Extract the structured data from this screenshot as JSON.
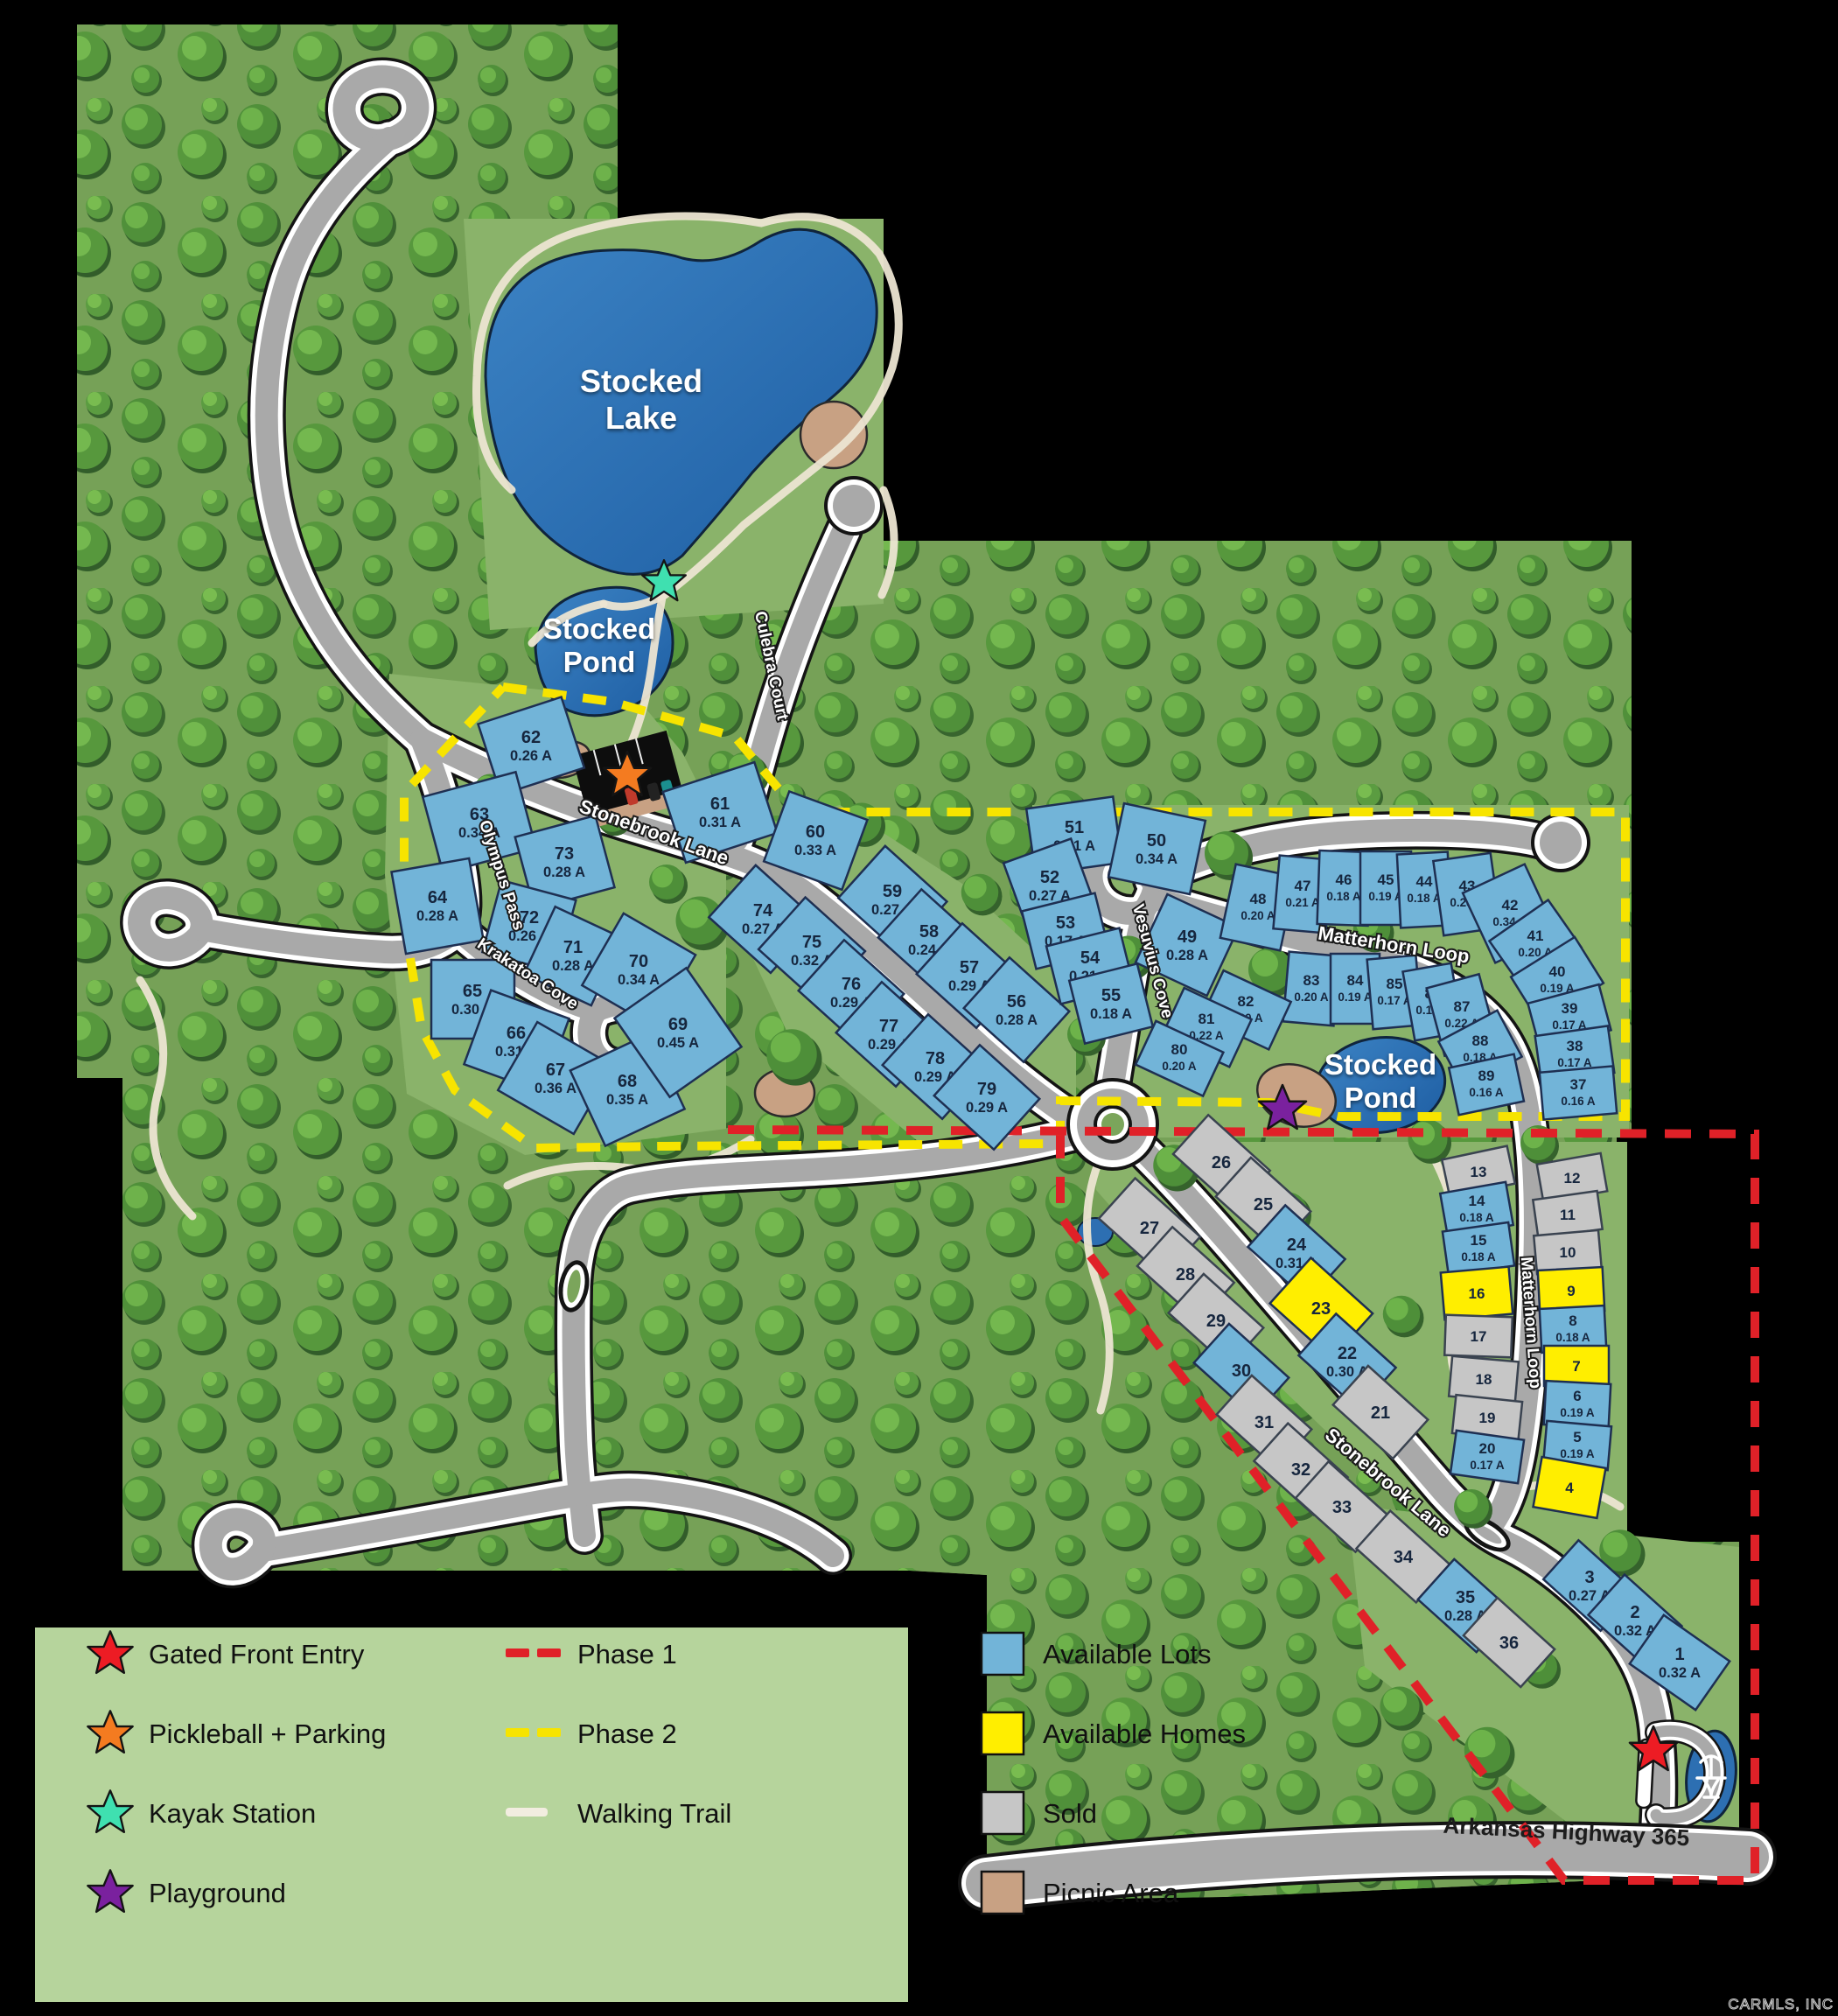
{
  "map": {
    "water": {
      "lake": {
        "l1": "Stocked",
        "l2": "Lake"
      },
      "pond_upper": {
        "l1": "Stocked",
        "l2": "Pond"
      },
      "pond_east": {
        "l1": "Stocked",
        "l2": "Pond"
      }
    },
    "streets": {
      "stonebrook": "Stonebrook Lane",
      "culebra": "Culebra Court",
      "olympus": "Olympus Pass",
      "krakatoa": "Krakatoa Cove",
      "vesuvius": "Vesuvius Cove",
      "matterhorn": "Matterhorn Loop",
      "highway": "Arkansas Highway 365"
    },
    "watermark": "CARMLS, INC"
  },
  "legend": {
    "markers": [
      {
        "icon": "star",
        "color": "#ed1c24",
        "label": "Gated Front Entry"
      },
      {
        "icon": "star",
        "color": "#f47b20",
        "label": "Pickleball + Parking"
      },
      {
        "icon": "star",
        "color": "#3fe0b0",
        "label": "Kayak Station"
      },
      {
        "icon": "star",
        "color": "#7a219e",
        "label": "Playground"
      }
    ],
    "lines": [
      {
        "style": "dashed",
        "color": "#e02128",
        "label": "Phase 1"
      },
      {
        "style": "dashed",
        "color": "#f7e400",
        "label": "Phase 2"
      },
      {
        "style": "solid",
        "color": "#f2ede0",
        "label": "Walking Trail"
      }
    ],
    "areas": [
      {
        "color": "#72b4d8",
        "label": "Available Lots"
      },
      {
        "color": "#ffee00",
        "label": "Available Homes"
      },
      {
        "color": "#c6c6c6",
        "label": "Sold"
      },
      {
        "color": "#c8a183",
        "label": "Picnic Area"
      }
    ]
  },
  "lots": [
    {
      "num": "1",
      "acre": "0.32 A",
      "status": "available"
    },
    {
      "num": "2",
      "acre": "0.32 A",
      "status": "available"
    },
    {
      "num": "3",
      "acre": "0.27 A",
      "status": "available"
    },
    {
      "num": "4",
      "acre": "",
      "status": "available-home"
    },
    {
      "num": "5",
      "acre": "0.19 A",
      "status": "available"
    },
    {
      "num": "6",
      "acre": "0.19 A",
      "status": "available"
    },
    {
      "num": "7",
      "acre": "",
      "status": "available-home"
    },
    {
      "num": "8",
      "acre": "0.18 A",
      "status": "available"
    },
    {
      "num": "9",
      "acre": "",
      "status": "available-home"
    },
    {
      "num": "10",
      "acre": "",
      "status": "sold"
    },
    {
      "num": "11",
      "acre": "",
      "status": "sold"
    },
    {
      "num": "12",
      "acre": "",
      "status": "sold"
    },
    {
      "num": "13",
      "acre": "",
      "status": "sold"
    },
    {
      "num": "14",
      "acre": "0.18 A",
      "status": "available"
    },
    {
      "num": "15",
      "acre": "0.18 A",
      "status": "available"
    },
    {
      "num": "16",
      "acre": "",
      "status": "available-home"
    },
    {
      "num": "17",
      "acre": "",
      "status": "sold"
    },
    {
      "num": "18",
      "acre": "",
      "status": "sold"
    },
    {
      "num": "19",
      "acre": "",
      "status": "sold"
    },
    {
      "num": "20",
      "acre": "0.17 A",
      "status": "available"
    },
    {
      "num": "21",
      "acre": "",
      "status": "sold"
    },
    {
      "num": "22",
      "acre": "0.30 A",
      "status": "available"
    },
    {
      "num": "23",
      "acre": "",
      "status": "available-home"
    },
    {
      "num": "24",
      "acre": "0.31 A",
      "status": "available"
    },
    {
      "num": "25",
      "acre": "",
      "status": "sold"
    },
    {
      "num": "26",
      "acre": "",
      "status": "sold"
    },
    {
      "num": "27",
      "acre": "",
      "status": "sold"
    },
    {
      "num": "28",
      "acre": "",
      "status": "sold"
    },
    {
      "num": "29",
      "acre": "",
      "status": "sold"
    },
    {
      "num": "30",
      "acre": "",
      "status": "available"
    },
    {
      "num": "31",
      "acre": "",
      "status": "sold"
    },
    {
      "num": "32",
      "acre": "",
      "status": "sold"
    },
    {
      "num": "33",
      "acre": "",
      "status": "sold"
    },
    {
      "num": "34",
      "acre": "",
      "status": "sold"
    },
    {
      "num": "35",
      "acre": "0.28 A",
      "status": "available"
    },
    {
      "num": "36",
      "acre": "",
      "status": "sold"
    },
    {
      "num": "37",
      "acre": "0.16 A",
      "status": "available"
    },
    {
      "num": "38",
      "acre": "0.17 A",
      "status": "available"
    },
    {
      "num": "39",
      "acre": "0.17 A",
      "status": "available"
    },
    {
      "num": "40",
      "acre": "0.19 A",
      "status": "available"
    },
    {
      "num": "41",
      "acre": "0.20 A",
      "status": "available"
    },
    {
      "num": "42",
      "acre": "0.34 A",
      "status": "available"
    },
    {
      "num": "43",
      "acre": "0.28 A",
      "status": "available"
    },
    {
      "num": "44",
      "acre": "0.18 A",
      "status": "available"
    },
    {
      "num": "45",
      "acre": "0.19 A",
      "status": "available"
    },
    {
      "num": "46",
      "acre": "0.18 A",
      "status": "available"
    },
    {
      "num": "47",
      "acre": "0.21 A",
      "status": "available"
    },
    {
      "num": "48",
      "acre": "0.20 A",
      "status": "available"
    },
    {
      "num": "49",
      "acre": "0.28 A",
      "status": "available"
    },
    {
      "num": "50",
      "acre": "0.34 A",
      "status": "available"
    },
    {
      "num": "51",
      "acre": "0.31 A",
      "status": "available"
    },
    {
      "num": "52",
      "acre": "0.27 A",
      "status": "available"
    },
    {
      "num": "53",
      "acre": "0.17 A",
      "status": "available"
    },
    {
      "num": "54",
      "acre": "0.21 A",
      "status": "available"
    },
    {
      "num": "55",
      "acre": "0.18 A",
      "status": "available"
    },
    {
      "num": "56",
      "acre": "0.28 A",
      "status": "available"
    },
    {
      "num": "57",
      "acre": "0.29 A",
      "status": "available"
    },
    {
      "num": "58",
      "acre": "0.24 A",
      "status": "available"
    },
    {
      "num": "59",
      "acre": "0.27 A",
      "status": "available"
    },
    {
      "num": "60",
      "acre": "0.33 A",
      "status": "available"
    },
    {
      "num": "61",
      "acre": "0.31 A",
      "status": "available"
    },
    {
      "num": "62",
      "acre": "0.26 A",
      "status": "available"
    },
    {
      "num": "63",
      "acre": "0.34 A",
      "status": "available"
    },
    {
      "num": "64",
      "acre": "0.28 A",
      "status": "available"
    },
    {
      "num": "65",
      "acre": "0.30 A",
      "status": "available"
    },
    {
      "num": "66",
      "acre": "0.31 A",
      "status": "available"
    },
    {
      "num": "67",
      "acre": "0.36 A",
      "status": "available"
    },
    {
      "num": "68",
      "acre": "0.35 A",
      "status": "available"
    },
    {
      "num": "69",
      "acre": "0.45 A",
      "status": "available"
    },
    {
      "num": "70",
      "acre": "0.34 A",
      "status": "available"
    },
    {
      "num": "71",
      "acre": "0.28 A",
      "status": "available"
    },
    {
      "num": "72",
      "acre": "0.26 A",
      "status": "available"
    },
    {
      "num": "73",
      "acre": "0.28 A",
      "status": "available"
    },
    {
      "num": "74",
      "acre": "0.27 A",
      "status": "available"
    },
    {
      "num": "75",
      "acre": "0.32 A",
      "status": "available"
    },
    {
      "num": "76",
      "acre": "0.29 A",
      "status": "available"
    },
    {
      "num": "77",
      "acre": "0.29 A",
      "status": "available"
    },
    {
      "num": "78",
      "acre": "0.29 A",
      "status": "available"
    },
    {
      "num": "79",
      "acre": "0.29 A",
      "status": "available"
    },
    {
      "num": "80",
      "acre": "0.20 A",
      "status": "available"
    },
    {
      "num": "81",
      "acre": "0.22 A",
      "status": "available"
    },
    {
      "num": "82",
      "acre": "0.20 A",
      "status": "available"
    },
    {
      "num": "83",
      "acre": "0.20 A",
      "status": "available"
    },
    {
      "num": "84",
      "acre": "0.19 A",
      "status": "available"
    },
    {
      "num": "85",
      "acre": "0.17 A",
      "status": "available"
    },
    {
      "num": "86",
      "acre": "0.19 A",
      "status": "available"
    },
    {
      "num": "87",
      "acre": "0.22 A",
      "status": "available"
    },
    {
      "num": "88",
      "acre": "0.18 A",
      "status": "available"
    },
    {
      "num": "89",
      "acre": "0.16 A",
      "status": "available"
    }
  ]
}
